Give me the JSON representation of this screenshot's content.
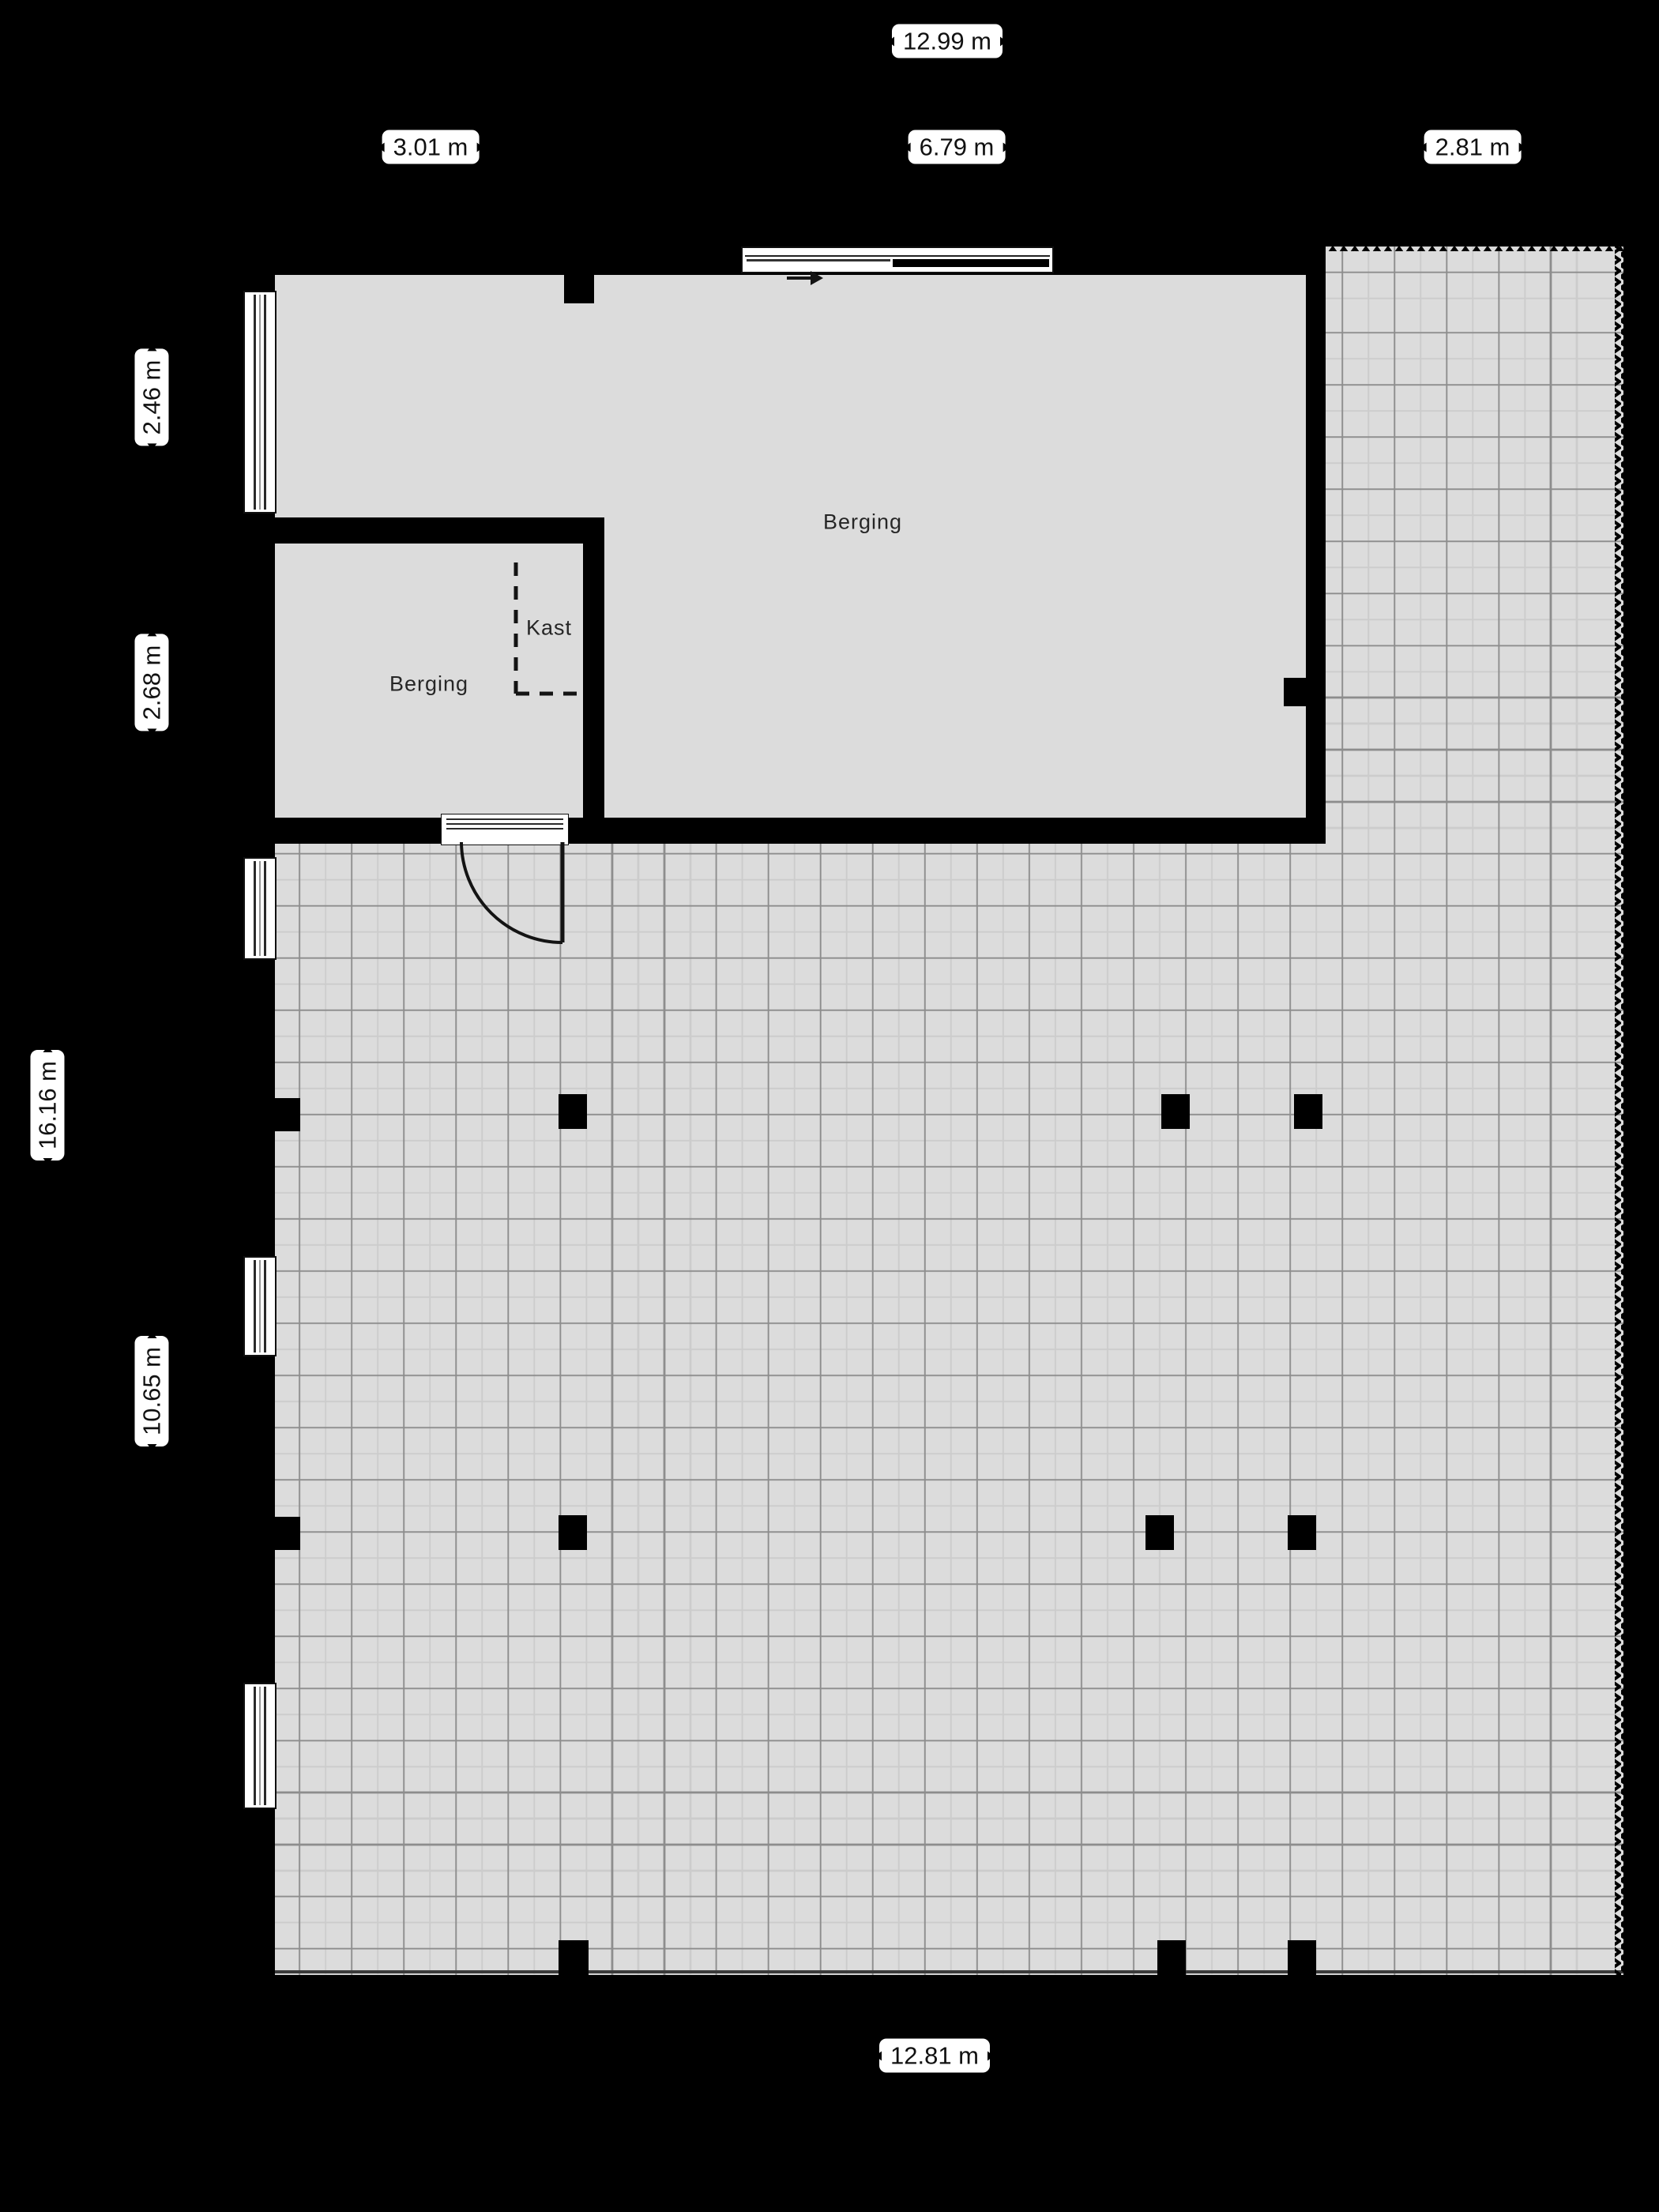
{
  "plan": {
    "rooms": {
      "berging_large": "Berging",
      "berging_small": "Berging",
      "kast": "Kast"
    },
    "dimensions": {
      "top_total": "12.99 m",
      "top_left_section": "3.01 m",
      "top_mid_section": "6.79 m",
      "top_right_section": "2.81 m",
      "left_upper_section": "2.46 m",
      "left_mid_section": "2.68 m",
      "left_total": "16.16 m",
      "left_lower_section": "10.65 m",
      "bottom_total": "12.81 m"
    },
    "colors": {
      "background": "#000000",
      "floor": "#dcdcdc",
      "wall": "#000000",
      "grid_major": "#8d8d8d",
      "grid_minor": "#cccccc",
      "label_background": "#ffffff",
      "label_text": "#111111"
    }
  }
}
